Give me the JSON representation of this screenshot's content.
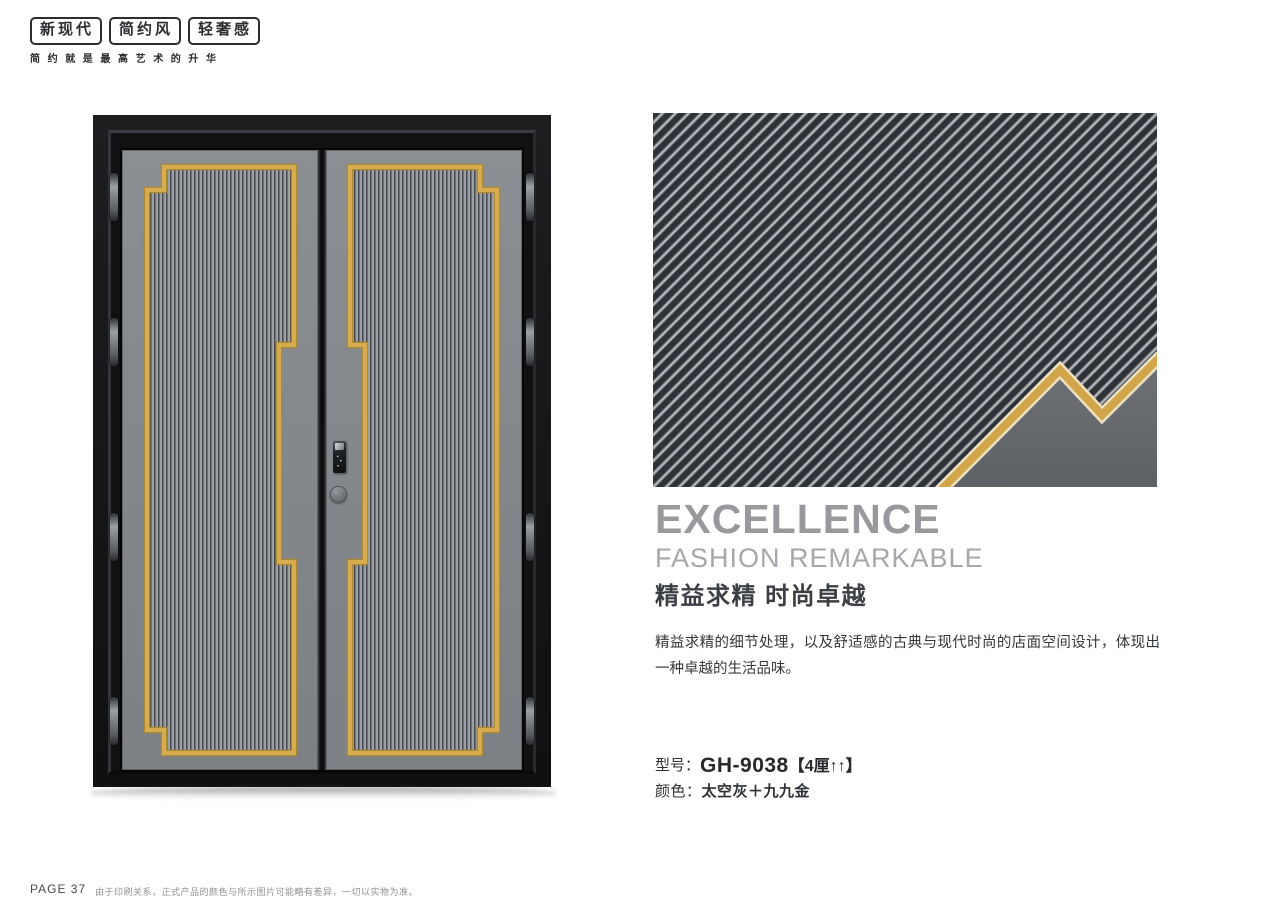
{
  "brand": {
    "badges": [
      "新现代",
      "简约风",
      "轻奢感"
    ],
    "slogan": "简约就是最高艺术的升华"
  },
  "headline": {
    "title_en": "EXCELLENCE",
    "subtitle_en": "FASHION REMARKABLE",
    "title_cn": "精益求精 时尚卓越",
    "description": "精益求精的细节处理，以及舒适感的古典与现代时尚的店面空间设计，体现出一种卓越的生活品味。"
  },
  "specs": {
    "model_label": "型号：",
    "model_value": "GH-9038",
    "model_note": "【4厘↑↑】",
    "color_label": "颜色：",
    "color_value": "太空灰＋九九金"
  },
  "footer": {
    "page_label": "PAGE 37",
    "disclaimer": "由于印刷关系，正式产品的颜色与所示图片可能略有差异，一切以实物为准。"
  },
  "colors": {
    "gold_accent": "#d2a74e",
    "gold_edge": "#a8862f",
    "leaf_gray": "#85898d",
    "door_stripe_dark": "#42454a",
    "door_stripe_light": "#aeb2b7",
    "banner_stripe_dark": "#2e3136",
    "banner_stripe_light": "#ced2d7",
    "banner_corner_gray": "#64676b",
    "frame_black": "#151517"
  }
}
